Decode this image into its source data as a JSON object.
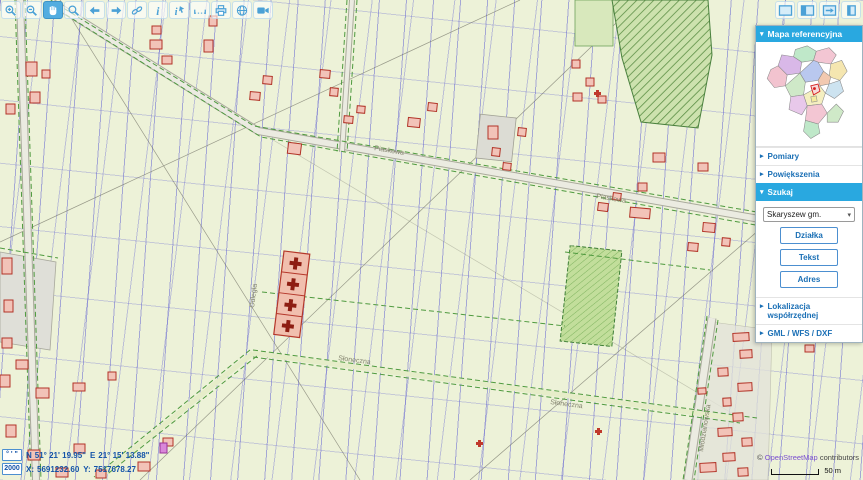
{
  "icons": {
    "expanded": "▾",
    "collapsed": "▸",
    "dropdown": "▾"
  },
  "toolbar": {
    "left": [
      "zoom-in",
      "zoom-out",
      "pan",
      "zoom-window",
      "previous-view",
      "next-view",
      "link",
      "info",
      "identify",
      "measure",
      "print",
      "globe",
      "snapshot"
    ],
    "right": [
      "layout-full",
      "layout-split",
      "toggle-panel",
      "panel-collapsed"
    ]
  },
  "sidebar": {
    "header": "Mapa referencyjna",
    "sections": [
      {
        "label": "Pomiary"
      },
      {
        "label": "Powiększenia"
      }
    ],
    "szukaj": {
      "label": "Szukaj",
      "select_value": "Skaryszew gm.",
      "buttons": [
        "Działka",
        "Tekst",
        "Adres"
      ]
    },
    "sections_bottom": [
      {
        "label": "Lokalizacja współrzędnej"
      },
      {
        "label": "GML / WFS / DXF"
      }
    ]
  },
  "map": {
    "street_labels": [
      "Piaskowa",
      "Piaskowa",
      "Słoneczna",
      "Słoneczna",
      "Odległa",
      "Młodzianowska"
    ]
  },
  "statusbar": {
    "dms_button": "° ' \"",
    "crs_button": "2000",
    "n_label": "N",
    "n_value": "51° 21' 19.95\"",
    "e_label": "E",
    "e_value": "21° 15' 13.88\"",
    "x_label": "X:",
    "x_value": "5691232.60",
    "y_label": "Y:",
    "y_value": "7517678.27"
  },
  "attribution": {
    "copyright": "©",
    "link": "OpenStreetMap",
    "suffix": "contributors",
    "scale_label": "50 m"
  },
  "colors": {
    "accent": "#29a8e0",
    "toolbar_icon": "#4ba1d6",
    "parcel_line": "#6969d2",
    "building_stroke": "#b23327",
    "building_fill": "#f2c3b8",
    "green_boundary": "#4f9a3f",
    "coords_text": "#1353a8"
  }
}
